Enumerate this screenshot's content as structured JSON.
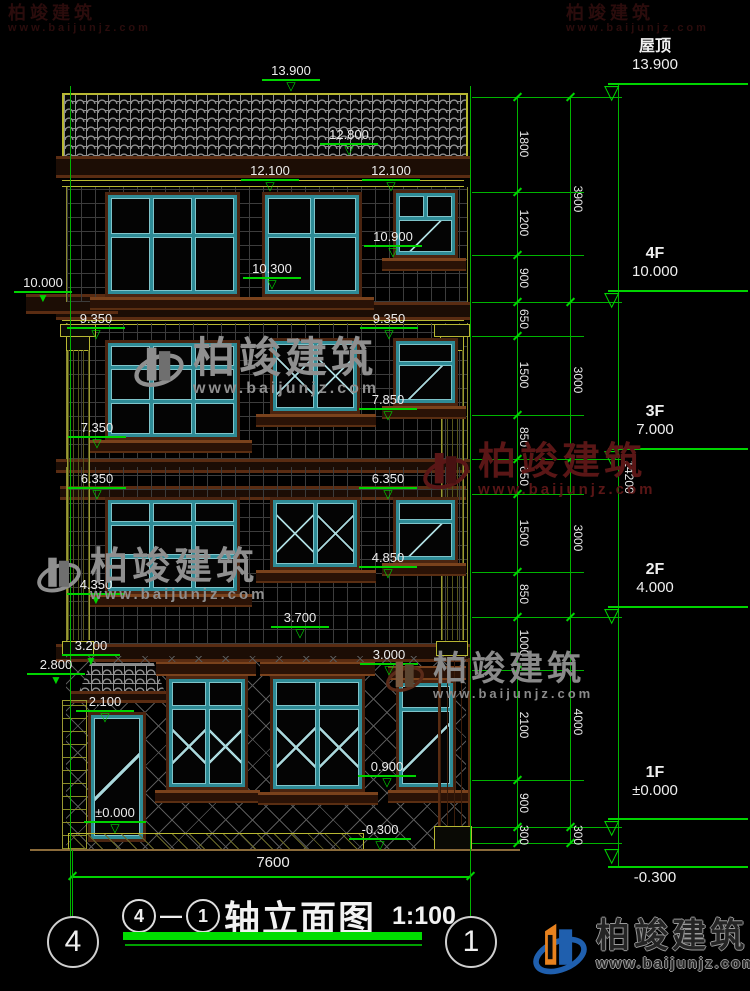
{
  "drawing": {
    "title": "轴立面图",
    "scale": "1:100",
    "axis_from": "4",
    "axis_to": "1",
    "dash": "—",
    "bottom_overall_dim": "7600",
    "overall_height_dim": "14200"
  },
  "floor_markers": [
    {
      "label": "屋顶",
      "value": "13.900"
    },
    {
      "label": "4F",
      "value": "10.000"
    },
    {
      "label": "3F",
      "value": "7.000"
    },
    {
      "label": "2F",
      "value": "4.000"
    },
    {
      "label": "1F",
      "value": "±0.000"
    },
    {
      "label": "",
      "value": "-0.300"
    }
  ],
  "building_markers": [
    {
      "value": "13.900"
    },
    {
      "value": "12.800"
    },
    {
      "value": "12.100"
    },
    {
      "value": "12.100"
    },
    {
      "value": "10.900"
    },
    {
      "value": "10.300"
    },
    {
      "value": "10.000"
    },
    {
      "value": "9.350"
    },
    {
      "value": "9.350"
    },
    {
      "value": "7.850"
    },
    {
      "value": "7.350"
    },
    {
      "value": "6.350"
    },
    {
      "value": "6.350"
    },
    {
      "value": "4.850"
    },
    {
      "value": "4.350"
    },
    {
      "value": "3.700"
    },
    {
      "value": "3.200"
    },
    {
      "value": "3.000"
    },
    {
      "value": "2.800"
    },
    {
      "value": "2.100"
    },
    {
      "value": "0.900"
    },
    {
      "value": "±0.000"
    },
    {
      "value": "-0.300"
    }
  ],
  "dim_chain_inner": [
    "1800",
    "1200",
    "900",
    "650",
    "1500",
    "850",
    "650",
    "1500",
    "850",
    "1000",
    "2100",
    "900",
    "300"
  ],
  "dim_chain_outer": [
    "3900",
    "3000",
    "3000",
    "4000",
    "300"
  ],
  "watermark": {
    "brand": "柏竣建筑",
    "url": "www.baijunjz.com"
  },
  "colors": {
    "dim_green": "#00d400",
    "text_white": "#ececec",
    "frame_teal": "#2e8b96",
    "trim_brown": "#5a2c12",
    "accent_yellow": "#b8b832",
    "watermark_gray": "#8f8f8f",
    "watermark_red": "#5a1616",
    "logo_blue": "#1f5fae",
    "logo_orange": "#e8821e"
  }
}
